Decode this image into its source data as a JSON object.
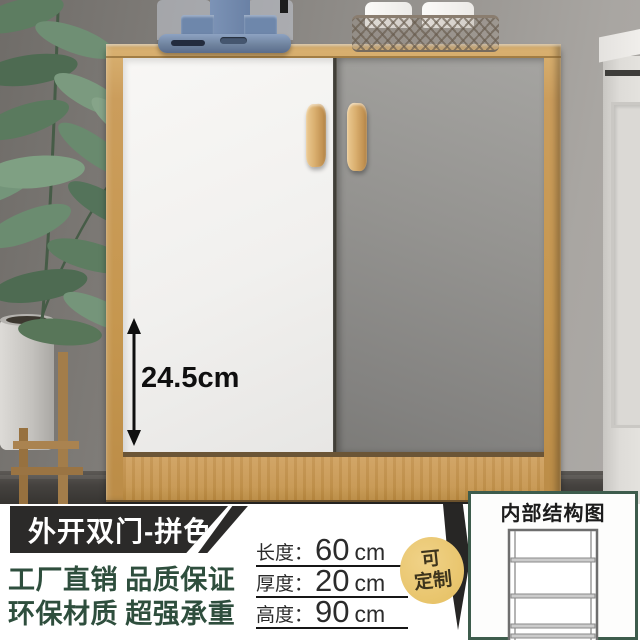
{
  "annotation": {
    "height_label": "24.5cm"
  },
  "footer": {
    "banner_label": "外开双门-拼色",
    "selling_points": [
      "工厂直销 品质保证",
      "环保材质 超强承重"
    ],
    "dimensions": [
      {
        "label": "长度：",
        "value": "60",
        "unit": "cm"
      },
      {
        "label": "厚度：",
        "value": "20",
        "unit": "cm"
      },
      {
        "label": "高度：",
        "value": "90",
        "unit": "cm"
      }
    ],
    "badge": {
      "line1": "可",
      "line2": "定制"
    }
  },
  "structure_panel": {
    "title": "内部结构图"
  },
  "colors": {
    "wood": "#c6974f",
    "door_white": "#f1f0ee",
    "door_gray": "#8e8d8a",
    "banner_black": "#2b2a29",
    "selling_text_green": "#2e4e3d",
    "badge_gold": "#e9c66c",
    "panel_border_green": "#3d5c4c",
    "arrow_black": "#0f0f0f"
  }
}
